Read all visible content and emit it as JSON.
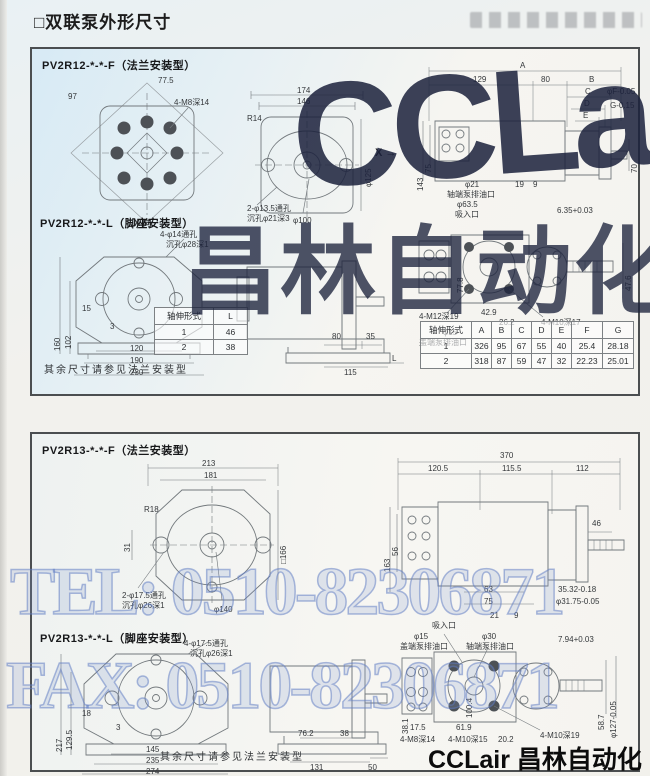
{
  "page": {
    "title": "□双联泵外形尺寸"
  },
  "watermark": {
    "tel": "TEL: 0510-82306871",
    "fax": "FAX: 0510-82306871",
    "brand_large": "CCLair",
    "brand_cjk": "昌林自动化",
    "footer_brand": "CCLair 昌林自动化"
  },
  "panel1": {
    "header_flange": "PV2R12-*-*-F（法兰安装型）",
    "header_foot": "PV2R12-*-*-L（脚座安装型）",
    "note": "其余尺寸请参见法兰安装型",
    "x_label": "X",
    "x_arrow": "→",
    "bolt": {
      "labels": [
        "77.5",
        "97",
        "4-M8深14",
        "X 向"
      ]
    },
    "front": {
      "labels": [
        "174",
        "146",
        "R14",
        "φ125",
        "2-φ13.5通孔",
        "沉孔φ21深3",
        "φ100"
      ]
    },
    "side": {
      "labels": [
        "A",
        "129",
        "80",
        "B",
        "C",
        "D",
        "E",
        "φF-0.05",
        "G-0.15",
        "143",
        "75",
        "70",
        "φ21",
        "轴端泵排油口",
        "φ63.5",
        "吸入口",
        "19",
        "9",
        "6.35+0.03"
      ]
    },
    "ports": {
      "labels": [
        "77.8",
        "42.9",
        "26.2",
        "4-M12深19",
        "4-M10深17",
        "φ15",
        "盖端泵排油口",
        "47.6"
      ]
    },
    "foot_front": {
      "labels": [
        "160",
        "102",
        "15",
        "3",
        "120",
        "190",
        "230",
        "4-φ14通孔",
        "沉孔φ28深1"
      ]
    },
    "foot_side": {
      "labels": [
        "80",
        "35",
        "115",
        "L"
      ]
    },
    "shaft_table": {
      "headers": [
        "轴伸形式",
        "L"
      ],
      "rows": [
        [
          "1",
          "46"
        ],
        [
          "2",
          "38"
        ]
      ]
    },
    "dim_table": {
      "headers": [
        "轴伸形式",
        "A",
        "B",
        "C",
        "D",
        "E",
        "F",
        "G"
      ],
      "rows": [
        [
          "1",
          "326",
          "95",
          "67",
          "55",
          "40",
          "25.4",
          "28.18"
        ],
        [
          "2",
          "318",
          "87",
          "59",
          "47",
          "32",
          "22.23",
          "25.01"
        ]
      ]
    }
  },
  "panel2": {
    "header_flange": "PV2R13-*-*-F（法兰安装型）",
    "header_foot": "PV2R13-*-*-L（脚座安装型）",
    "note": "其余尺寸请参见法兰安装型",
    "flange": {
      "labels": [
        "213",
        "181",
        "R18",
        "31",
        "□166",
        "2-φ17.5通孔",
        "沉孔φ26深1",
        "φ140"
      ]
    },
    "side": {
      "labels": [
        "370",
        "120.5",
        "115.5",
        "112",
        "46",
        "163",
        "56",
        "63",
        "75",
        "35.32-0.18",
        "φ31.75-0.05",
        "21",
        "9"
      ]
    },
    "foot_front": {
      "labels": [
        "217",
        "129.5",
        "18",
        "3",
        "145",
        "235",
        "274",
        "4-φ17.5通孔",
        "沉孔φ26深1"
      ]
    },
    "foot_side": {
      "labels": [
        "76.2",
        "38",
        "131",
        "50"
      ]
    },
    "ports": {
      "labels": [
        "吸入口",
        "φ15",
        "盖端泵排油口",
        "φ30",
        "轴端泵排油口",
        "7.94+0.03",
        "38.1",
        "17.5",
        "4-M8深14",
        "100.4",
        "61.9",
        "4-M10深15",
        "20.2",
        "4-M10深19",
        "58.7",
        "φ127-0.05"
      ]
    }
  }
}
